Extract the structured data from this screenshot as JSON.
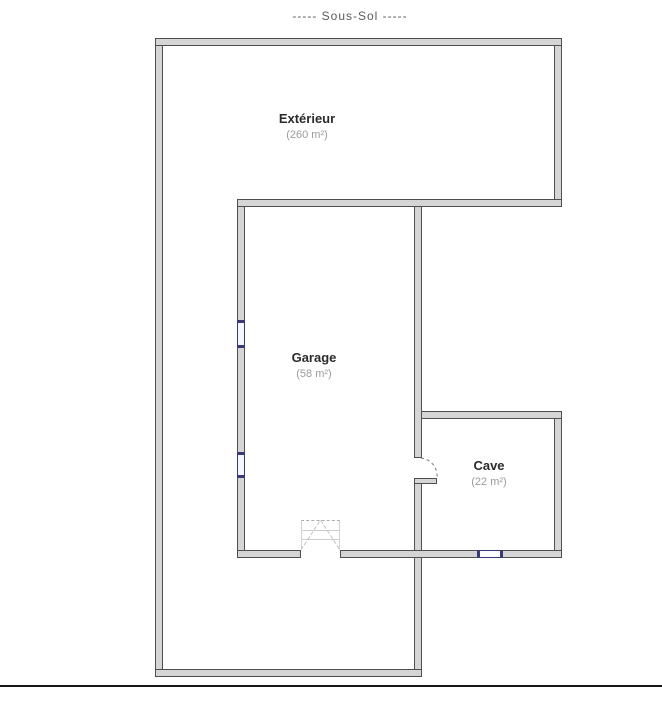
{
  "title": "-----  Sous-Sol  -----",
  "rooms": [
    {
      "name": "Extérieur",
      "area": "(260 m²)"
    },
    {
      "name": "Garage",
      "area": "(58 m²)"
    },
    {
      "name": "Cave",
      "area": "(22 m²)"
    }
  ],
  "colors": {
    "wall_fill": "#d5d5d5",
    "wall_edge": "#4f4f4f",
    "window_accent": "#3a3a78",
    "door_arc": "#8a8a8a",
    "garage_door_lines": "#c2c2c2",
    "separator_line": "#161616",
    "room_name_text": "#2b2b2b",
    "room_area_text": "#9b9b9b",
    "title_text": "#5a5a5a"
  }
}
